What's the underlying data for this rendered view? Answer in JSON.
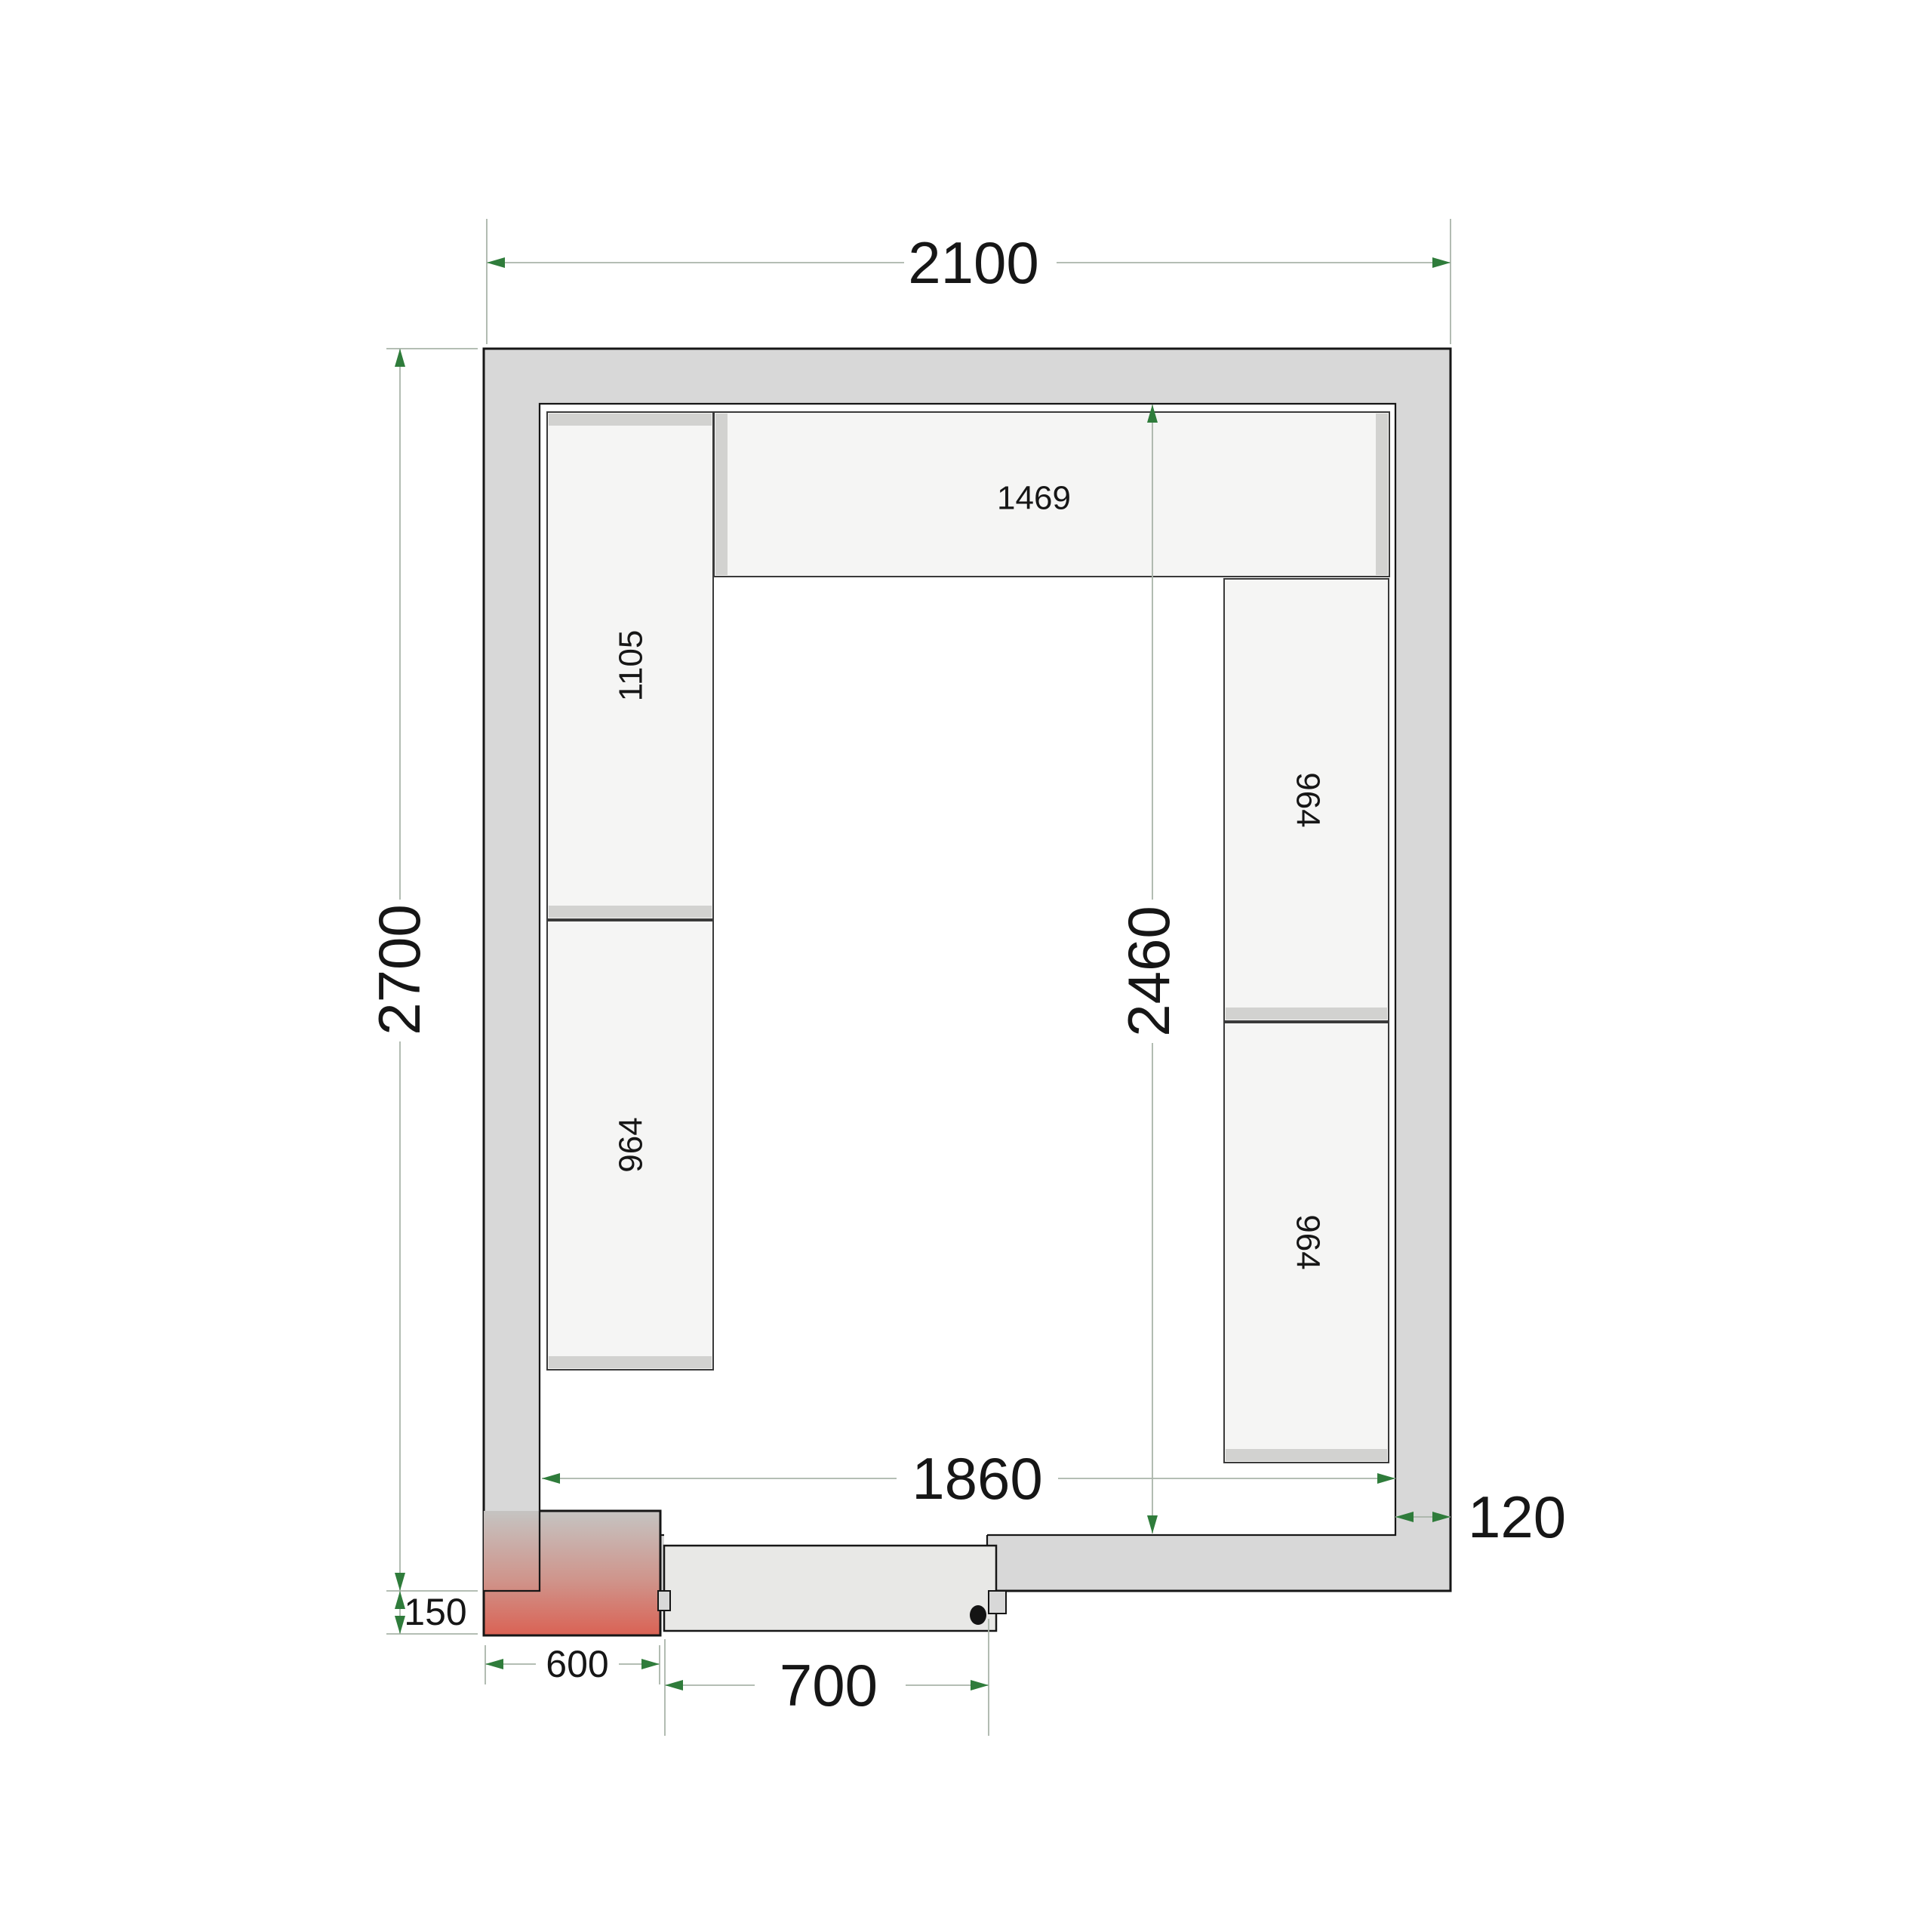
{
  "drawing": {
    "title": "Cold room floor plan - top view with shelving, door and cooling unit"
  },
  "dims": {
    "outer_width": "2100",
    "outer_height": "2700",
    "inner_width": "1860",
    "inner_height": "2460",
    "wall_thickness": "120",
    "door_width": "700",
    "unit_width": "600",
    "unit_protrusion": "150"
  },
  "shelves": {
    "top": "1469",
    "left_upper": "1105",
    "left_lower": "964",
    "right_upper": "964",
    "right_lower": "964"
  },
  "colors": {
    "wall": "#d8d8d8",
    "outline": "#161616",
    "shelf": "#f5f5f4",
    "shelf_outline": "#3a3a3a",
    "shelf_cap": "#d2d2d0",
    "door": "#e8e8e6",
    "dim_line": "#a9b4a9",
    "arrow_green": "#2f7c3b",
    "text": "#161616",
    "unit_gradient_top": "#c5c4c2",
    "unit_gradient_mid": "#cf958c",
    "unit_gradient_bottom": "#da6254"
  }
}
